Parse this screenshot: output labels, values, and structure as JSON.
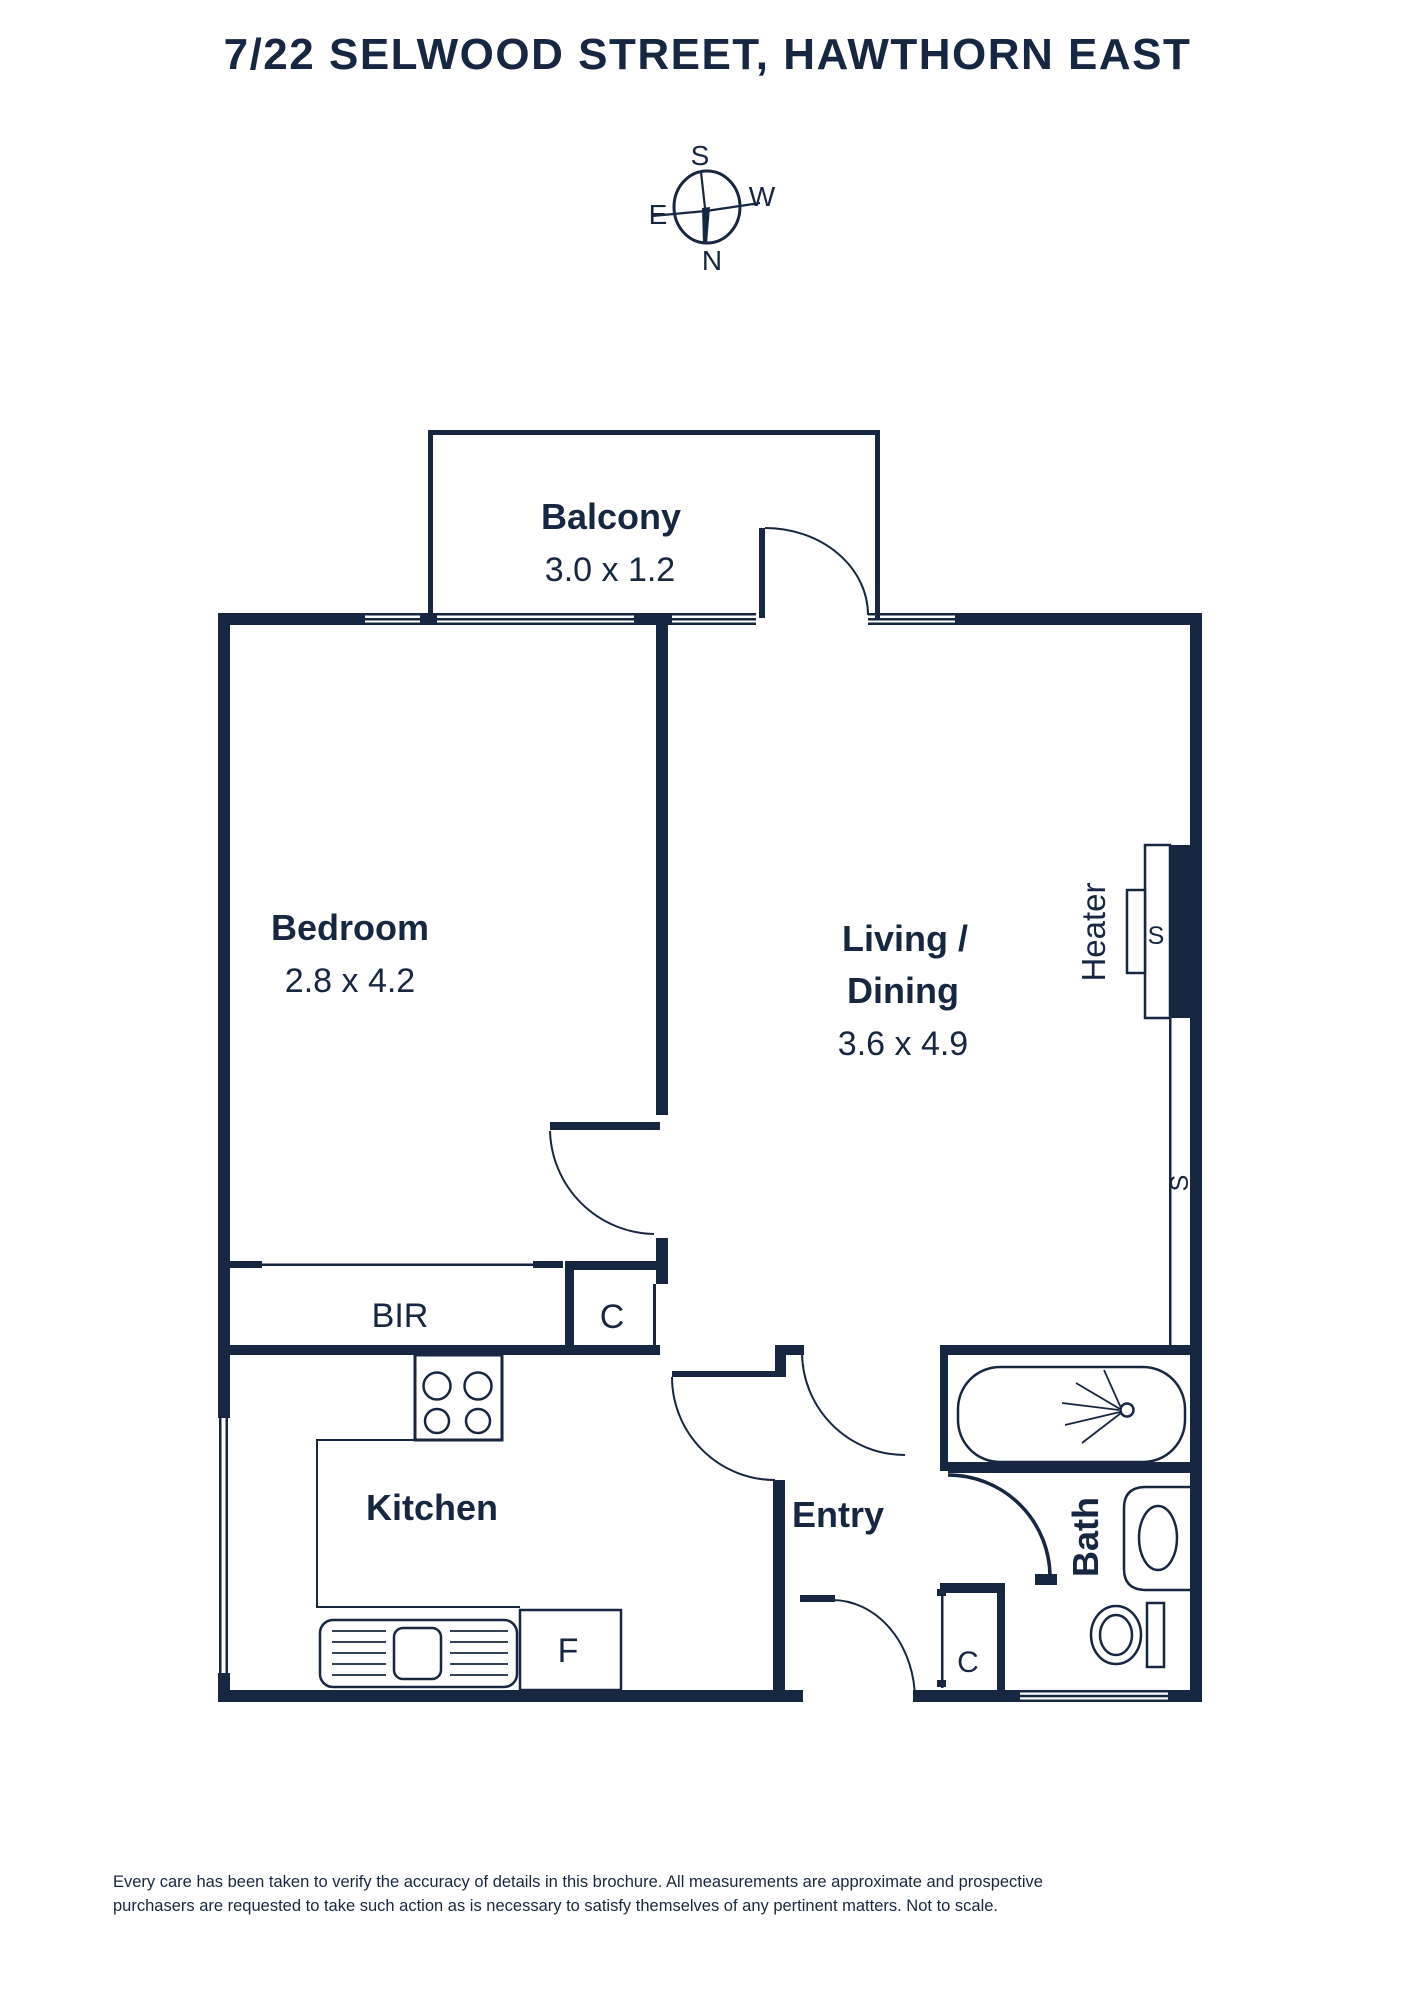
{
  "title": "7/22 SELWOOD STREET, HAWTHORN EAST",
  "compass": {
    "s": "S",
    "w": "W",
    "e": "E",
    "n": "N"
  },
  "rooms": {
    "balcony": {
      "name": "Balcony",
      "dims": "3.0 x 1.2"
    },
    "bedroom": {
      "name": "Bedroom",
      "dims": "2.8 x 4.2"
    },
    "living": {
      "line1": "Living /",
      "line2": "Dining",
      "dims": "3.6 x 4.9"
    },
    "kitchen": {
      "name": "Kitchen"
    },
    "entry": {
      "name": "Entry"
    },
    "bath": {
      "name": "Bath"
    }
  },
  "fixtures": {
    "bir": "BIR",
    "hall_closet": "C",
    "entry_closet": "C",
    "fridge": "F",
    "heater": "Heater",
    "heater_s": "S",
    "wall_s": "S"
  },
  "footer": {
    "line1": "Every care has been taken to verify the accuracy of details in this brochure. All measurements are approximate and prospective",
    "line2": "purchasers are requested to take such action as is necessary to satisfy themselves of any pertinent matters. Not to scale."
  },
  "colors": {
    "ink": "#182741",
    "paper": "#ffffff"
  }
}
